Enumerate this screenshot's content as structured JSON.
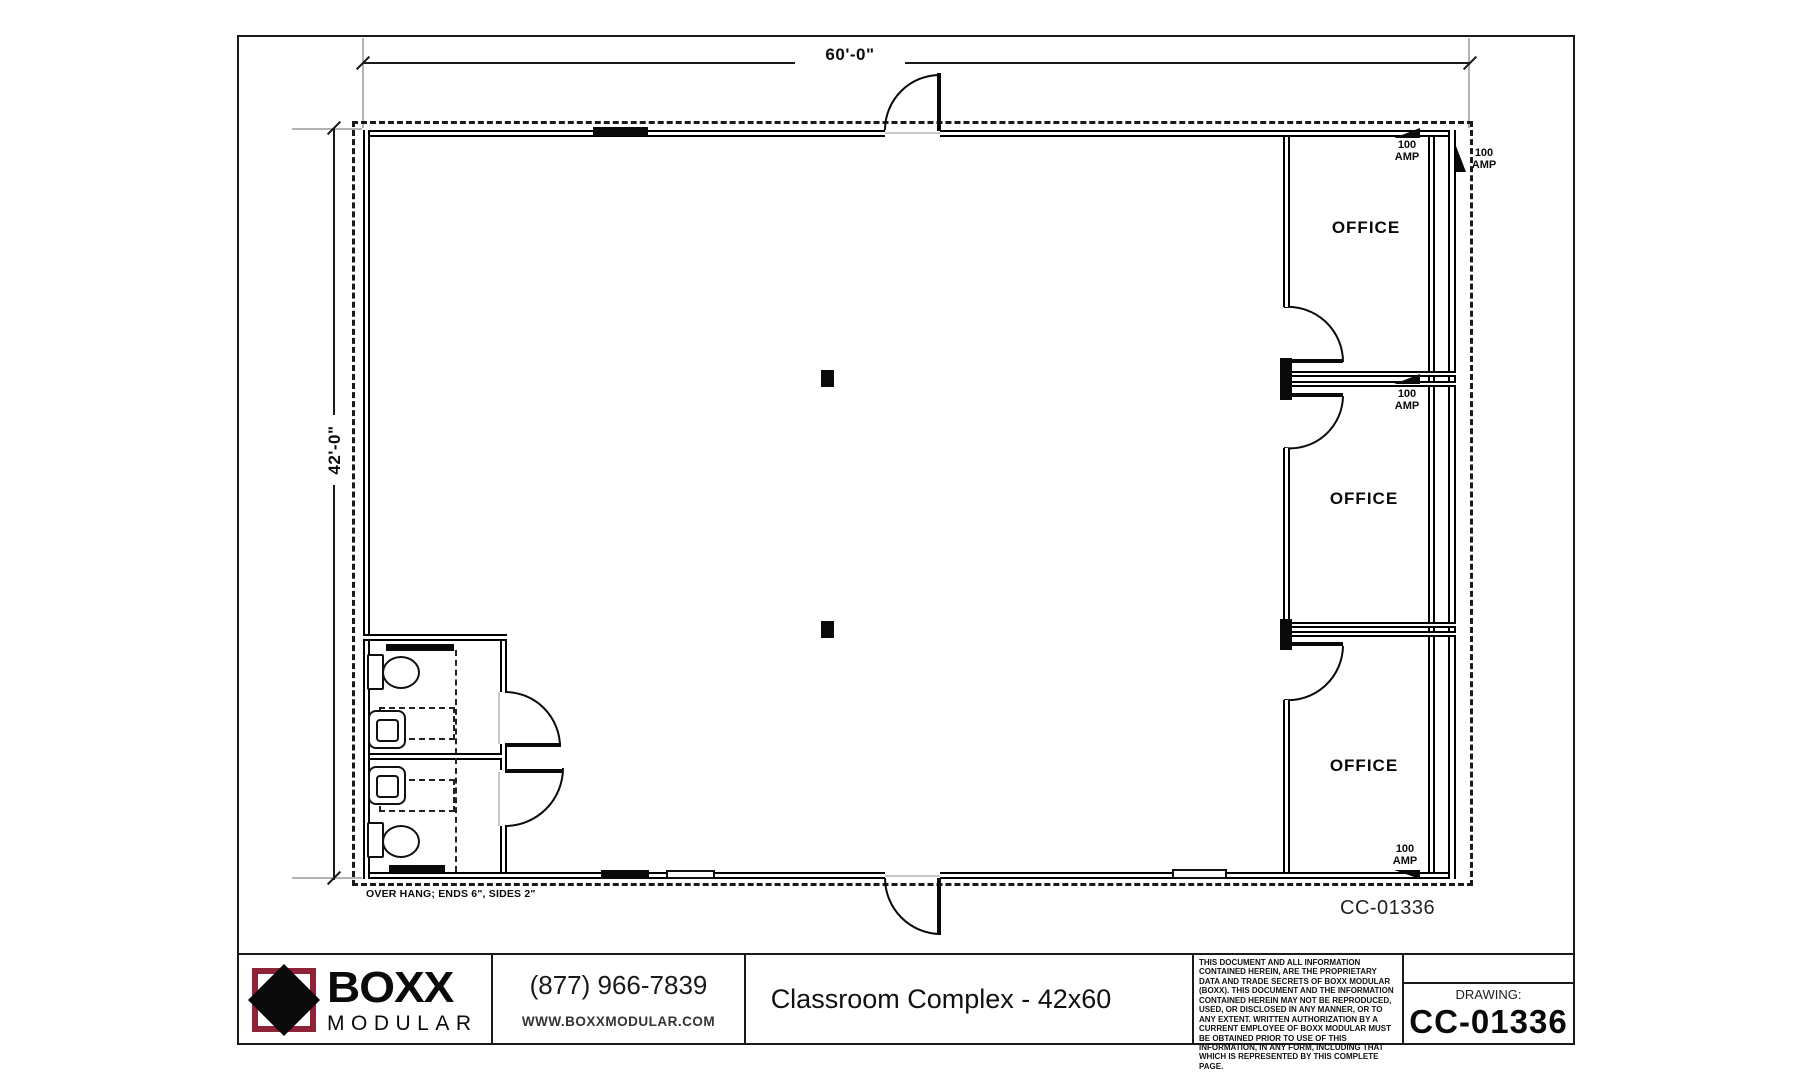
{
  "sheet": {
    "plan": {
      "width_dim": "60'-0\"",
      "height_dim": "42'-0\"",
      "overhang_note": "OVER HANG; ENDS 6\", SIDES 2\"",
      "plan_number": "CC-01336",
      "office_labels": [
        "OFFICE",
        "OFFICE",
        "OFFICE"
      ],
      "amp_markers": [
        "100\nAMP",
        "100\nAMP",
        "100\nAMP",
        "100\nAMP"
      ]
    },
    "title_block": {
      "brand_name": "BOXX",
      "brand_subname": "MODULAR",
      "phone": "(877) 966-7839",
      "website": "WWW.BOXXMODULAR.COM",
      "drawing_title": "Classroom Complex - 42x60",
      "legal_text": "THIS DOCUMENT AND ALL INFORMATION CONTAINED HEREIN, ARE THE PROPRIETARY DATA AND TRADE SECRETS OF BOXX MODULAR (BOXX). THIS DOCUMENT AND THE INFORMATION CONTAINED HEREIN MAY NOT BE REPRODUCED, USED, OR DISCLOSED IN ANY MANNER, OR TO ANY EXTENT.  WRITTEN AUTHORIZATION BY A CURRENT EMPLOYEE OF BOXX MODULAR MUST BE OBTAINED PRIOR TO USE OF THIS INFORMATION, IN ANY FORM, INCLUDING THAT WHICH IS REPRESENTED BY THIS COMPLETE PAGE."
    },
    "title_block_labels": {
      "drawing_label": "DRAWING:",
      "drawing_number": "CC-01336"
    },
    "colors": {
      "brand_maroon": "#8e2237",
      "line_black": "#000000"
    }
  }
}
